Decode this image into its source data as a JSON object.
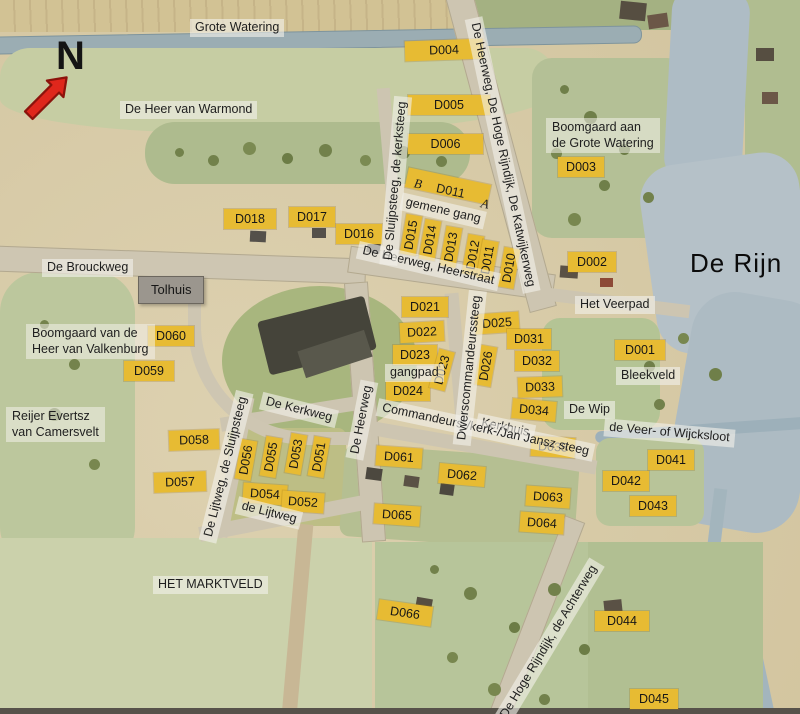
{
  "compass": {
    "label": "N"
  },
  "colors": {
    "plot_label_bg": "#e7bb33",
    "street_label_bg": "#f0efe8",
    "water": "#aebcc5",
    "field": "#b7c398",
    "road": "#cec6b2",
    "north_arrow": "#df271c"
  },
  "plot_labels": [
    {
      "id": "D004",
      "x": 405,
      "y": 40,
      "w": 78,
      "rot": -2
    },
    {
      "id": "D005",
      "x": 408,
      "y": 95,
      "w": 82
    },
    {
      "id": "D006",
      "x": 408,
      "y": 134,
      "w": 75
    },
    {
      "id": "D003",
      "x": 558,
      "y": 157,
      "w": 46
    },
    {
      "id": "D018",
      "x": 224,
      "y": 209,
      "w": 52
    },
    {
      "id": "D017",
      "x": 289,
      "y": 207,
      "w": 46
    },
    {
      "id": "D016",
      "x": 336,
      "y": 224,
      "w": 46
    },
    {
      "id": "D002",
      "x": 568,
      "y": 252,
      "w": 48
    },
    {
      "id": "D001",
      "x": 615,
      "y": 340,
      "w": 50
    },
    {
      "id": "D060",
      "x": 148,
      "y": 326,
      "w": 46
    },
    {
      "id": "D059",
      "x": 124,
      "y": 361,
      "w": 50
    },
    {
      "id": "D021",
      "x": 402,
      "y": 297,
      "w": 46
    },
    {
      "id": "D022",
      "x": 400,
      "y": 322,
      "w": 44,
      "rot": -3
    },
    {
      "id": "D023",
      "x": 393,
      "y": 345,
      "w": 44
    },
    {
      "id": "D024",
      "x": 386,
      "y": 381,
      "w": 44
    },
    {
      "id": "D025",
      "x": 475,
      "y": 313,
      "w": 44,
      "rot": -4
    },
    {
      "id": "D031",
      "x": 507,
      "y": 329,
      "w": 44
    },
    {
      "id": "D032",
      "x": 515,
      "y": 351,
      "w": 44
    },
    {
      "id": "D033",
      "x": 518,
      "y": 377,
      "w": 44,
      "rot": -2
    },
    {
      "id": "D034",
      "x": 512,
      "y": 400,
      "w": 44,
      "rot": 5
    },
    {
      "id": "D035",
      "x": 531,
      "y": 437,
      "w": 44,
      "rot": 3
    },
    {
      "id": "D041",
      "x": 648,
      "y": 450,
      "w": 46
    },
    {
      "id": "D042",
      "x": 603,
      "y": 471,
      "w": 46
    },
    {
      "id": "D043",
      "x": 630,
      "y": 496,
      "w": 46
    },
    {
      "id": "D058",
      "x": 169,
      "y": 430,
      "w": 50,
      "rot": -2
    },
    {
      "id": "D057",
      "x": 154,
      "y": 472,
      "w": 52,
      "rot": -2
    },
    {
      "id": "D054",
      "x": 243,
      "y": 484,
      "w": 44,
      "rot": 4
    },
    {
      "id": "D052",
      "x": 282,
      "y": 492,
      "w": 42,
      "rot": 4
    },
    {
      "id": "D061",
      "x": 376,
      "y": 447,
      "w": 46,
      "rot": 4
    },
    {
      "id": "D062",
      "x": 439,
      "y": 465,
      "w": 46,
      "rot": 5
    },
    {
      "id": "D063",
      "x": 526,
      "y": 487,
      "w": 44,
      "rot": 4
    },
    {
      "id": "D064",
      "x": 520,
      "y": 513,
      "w": 44,
      "rot": 4
    },
    {
      "id": "D065",
      "x": 374,
      "y": 505,
      "w": 46,
      "rot": 4
    },
    {
      "id": "D066",
      "x": 378,
      "y": 603,
      "w": 54,
      "rot": 8
    },
    {
      "id": "D044",
      "x": 595,
      "y": 611,
      "w": 54
    },
    {
      "id": "D045",
      "x": 630,
      "y": 689,
      "w": 48
    },
    {
      "id": "D015",
      "x": 391,
      "y": 227,
      "rot": -80,
      "vert": true
    },
    {
      "id": "D014",
      "x": 410,
      "y": 232,
      "rot": -80,
      "vert": true
    },
    {
      "id": "D013",
      "x": 431,
      "y": 239,
      "rot": -80,
      "vert": true
    },
    {
      "id": "D012",
      "x": 453,
      "y": 247,
      "rot": -80,
      "vert": true
    },
    {
      "id": "D011",
      "x": 468,
      "y": 252,
      "rot": -80,
      "vert": true
    },
    {
      "id": "D010",
      "x": 489,
      "y": 260,
      "rot": -80,
      "vert": true
    },
    {
      "id": "D023",
      "x": 422,
      "y": 362,
      "rot": -75,
      "vert": true
    },
    {
      "id": "D026",
      "x": 466,
      "y": 358,
      "rot": -80,
      "vert": true
    },
    {
      "id": "D056",
      "x": 226,
      "y": 452,
      "rot": -80,
      "vert": true
    },
    {
      "id": "D055",
      "x": 251,
      "y": 449,
      "rot": -80,
      "vert": true
    },
    {
      "id": "D053",
      "x": 276,
      "y": 446,
      "rot": -80,
      "vert": true
    },
    {
      "id": "D051",
      "x": 299,
      "y": 449,
      "rot": -80,
      "vert": true
    }
  ],
  "text_labels": [
    {
      "text": "Grote Watering",
      "style": "street",
      "x": 190,
      "y": 19
    },
    {
      "text": "De Heer van Warmond",
      "style": "street",
      "x": 120,
      "y": 101
    },
    {
      "text": "Boomgaard aan\nde Grote Watering",
      "style": "area",
      "x": 546,
      "y": 118
    },
    {
      "text": "De Rijn",
      "style": "big",
      "x": 690,
      "y": 247
    },
    {
      "text": "De Brouckweg",
      "style": "street",
      "x": 42,
      "y": 259
    },
    {
      "text": "Tolhuis",
      "style": "tolhuis",
      "x": 138,
      "y": 276
    },
    {
      "text": "De Heerweg, Heerstraat",
      "style": "street",
      "x": 356,
      "y": 257,
      "rot": 13
    },
    {
      "text": "Het Veerpad",
      "style": "street",
      "x": 575,
      "y": 296
    },
    {
      "text": "Boomgaard van de\nHeer van Valkenburg",
      "style": "area",
      "x": 26,
      "y": 324
    },
    {
      "text": "Reijer Evertsz\nvan Camersvelt",
      "style": "area",
      "x": 6,
      "y": 407
    },
    {
      "text": "Bleekveld",
      "style": "street",
      "x": 616,
      "y": 367
    },
    {
      "text": "gemene gang",
      "style": "street",
      "x": 400,
      "y": 202,
      "rot": 13
    },
    {
      "text": "gangpad",
      "style": "street",
      "x": 385,
      "y": 364
    },
    {
      "text": "De Kerkweg",
      "style": "street",
      "x": 260,
      "y": 401,
      "rot": 14
    },
    {
      "text": "de Lijtweg",
      "style": "street",
      "x": 236,
      "y": 504,
      "rot": 14
    },
    {
      "text": "De Wip",
      "style": "street",
      "x": 564,
      "y": 401
    },
    {
      "text": "Kerkhuis",
      "style": "street",
      "x": 476,
      "y": 419,
      "rot": 12
    },
    {
      "text": "Commandeurs-/kerk-/Jan Jansz steeg",
      "style": "street",
      "x": 375,
      "y": 421,
      "rot": 12
    },
    {
      "text": "de Veer- of Wijcksloot",
      "style": "street",
      "x": 604,
      "y": 424,
      "rot": 5
    },
    {
      "text": "HET MARKTVELD",
      "style": "street",
      "x": 153,
      "y": 576
    },
    {
      "text": "De Sluijpsteeg, de kerksteeg",
      "style": "street",
      "x": 311,
      "y": 172,
      "rot": -85
    },
    {
      "text": "De Heerweg, De Hoge Rijndijk, De Katwijkerweg",
      "style": "street",
      "x": 363,
      "y": 146,
      "rot": 78
    },
    {
      "text": "Dwerscommandeurssteeg",
      "style": "street",
      "x": 392,
      "y": 359,
      "rot": -84
    },
    {
      "text": "De Heerweg",
      "style": "street",
      "x": 322,
      "y": 411,
      "rot": -79
    },
    {
      "text": "De Lijtweg, de Sluijpsteeg",
      "style": "street",
      "x": 149,
      "y": 458,
      "rot": -76
    },
    {
      "text": "De Hoge Rijndijk, de Achterweg",
      "style": "street",
      "x": 456,
      "y": 633,
      "rot": -59
    },
    {
      "text": "B",
      "style": "letter",
      "x": 414,
      "y": 176,
      "rot": 12
    },
    {
      "text": "D011",
      "style": "onstrip",
      "x": 436,
      "y": 184,
      "rot": 12
    },
    {
      "text": "A",
      "style": "letter",
      "x": 481,
      "y": 196,
      "rot": 12
    }
  ]
}
